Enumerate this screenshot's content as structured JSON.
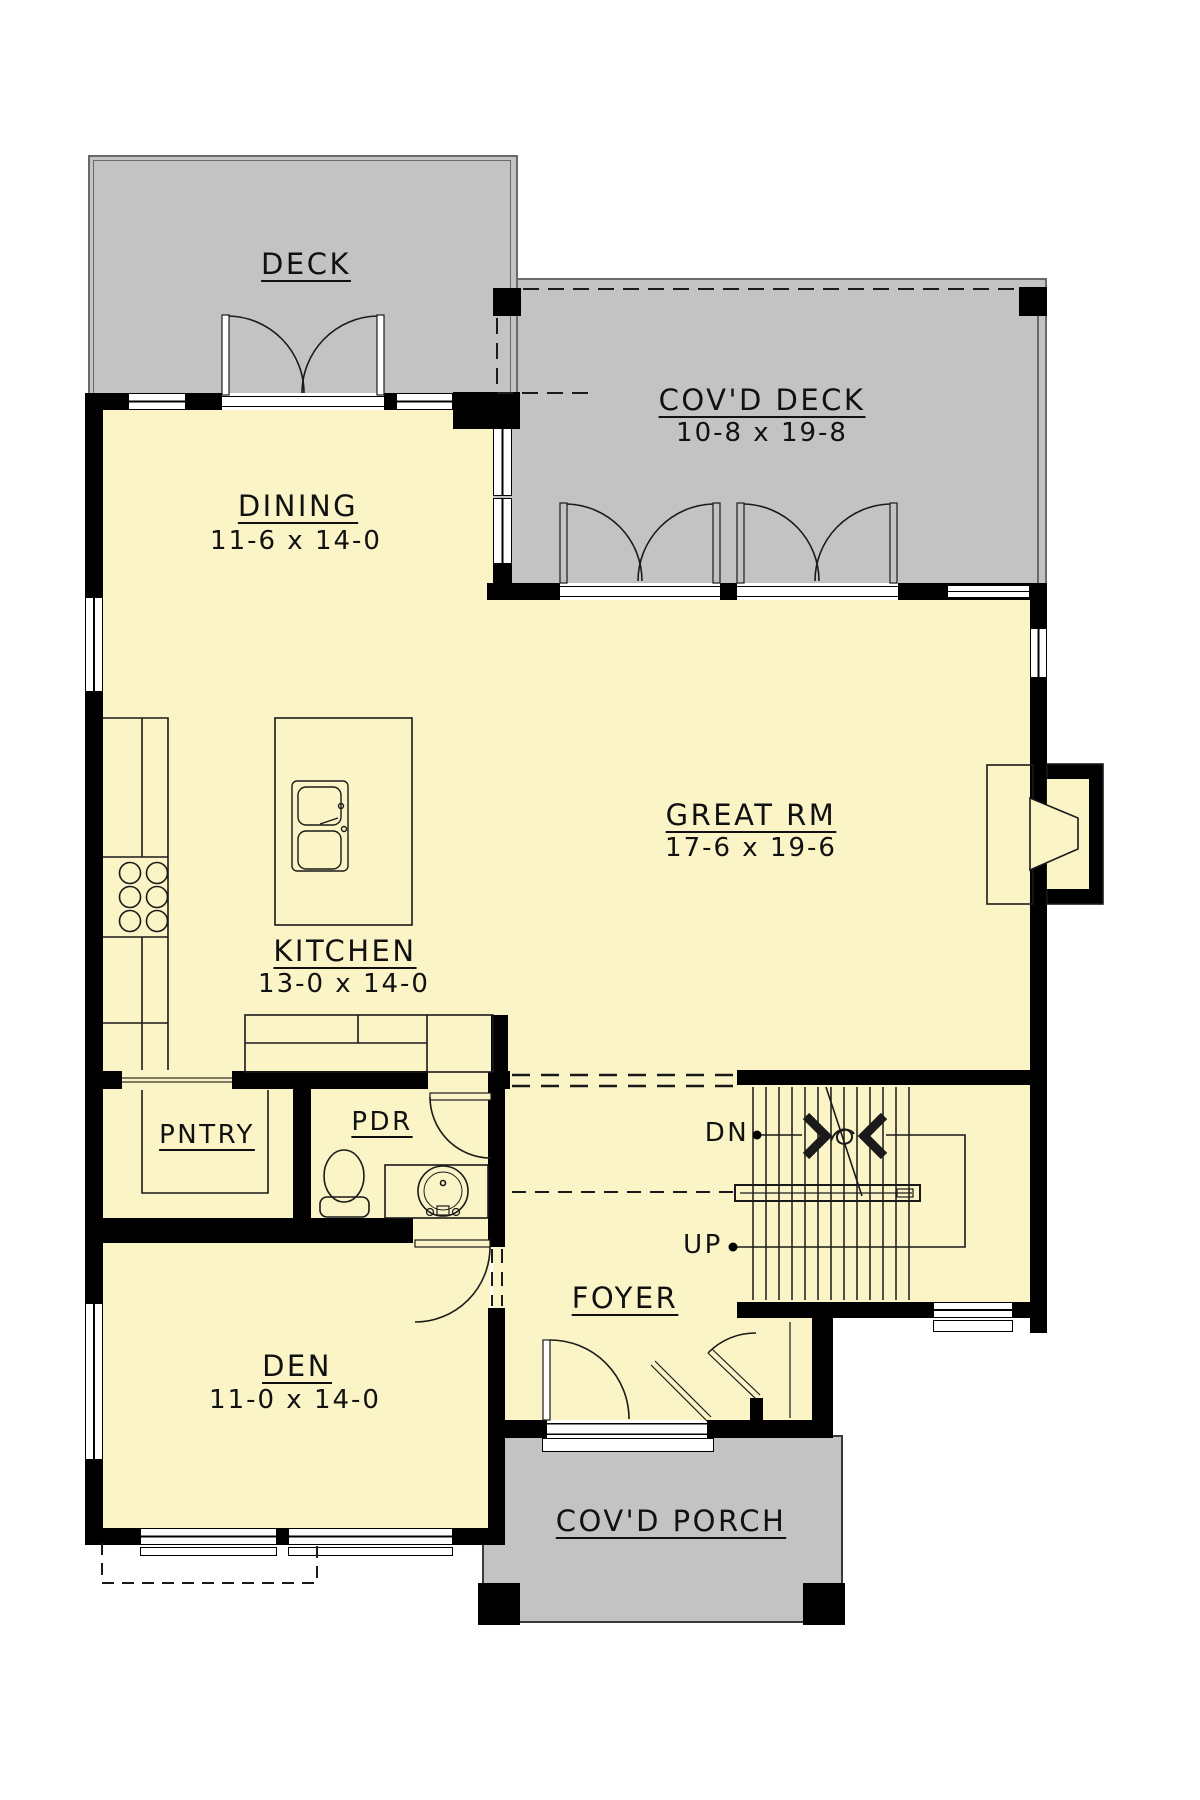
{
  "plan_title": "Main floor plan",
  "colors": {
    "floor": "#faf4c6",
    "deck": "#c3c3c3",
    "wall": "#000000",
    "linework": "#1a1a1a",
    "deck_edge": "#6a6a6a"
  },
  "rooms": {
    "deck": {
      "name": "DECK"
    },
    "covd_deck": {
      "name": "COV'D DECK",
      "dims": "10-8 x 19-8"
    },
    "dining": {
      "name": "DINING",
      "dims": "11-6 x 14-0"
    },
    "great_rm": {
      "name": "GREAT RM",
      "dims": "17-6 x 19-6"
    },
    "kitchen": {
      "name": "KITCHEN",
      "dims": "13-0 x 14-0"
    },
    "pntry": {
      "name": "PNTRY"
    },
    "pdr": {
      "name": "PDR"
    },
    "foyer": {
      "name": "FOYER"
    },
    "den": {
      "name": "DEN",
      "dims": "11-0 x 14-0"
    },
    "covd_porch": {
      "name": "COV'D PORCH"
    }
  },
  "stairs": {
    "down_label": "DN",
    "up_label": "UP"
  }
}
